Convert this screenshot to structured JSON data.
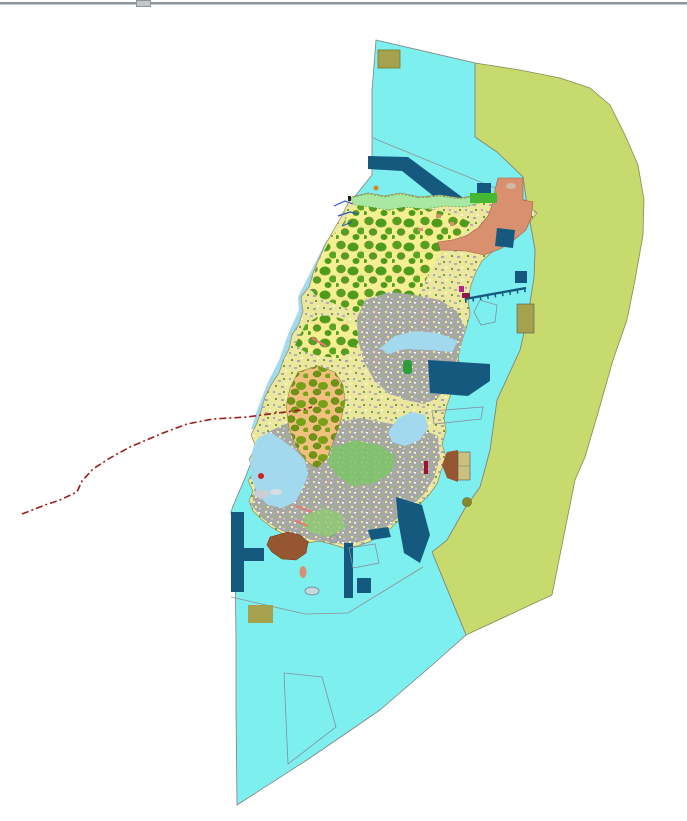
{
  "window": {
    "edge_bar_color": "#8C969C",
    "edge_bar_highlight": "#C4CBCF",
    "scroll_tab_color": "#C2C7CA"
  },
  "map": {
    "colors": {
      "background": "#FFFFFF",
      "sea": "#7EEFEF",
      "outer_zone": "#C6DA6E",
      "zone_border": "#8A8A50",
      "island_outline": "#8A8A5A",
      "forest_green": "#55A01E",
      "orchard_tan": "#EFC07E",
      "orchard_olive": "#6F9414",
      "urban_gray": "#A7A7A7",
      "coast_greenbelt": "#A9E8A2",
      "bright_green_parcel": "#44B830",
      "inlet_blue": "#A3D9EE",
      "salmon_zone": "#D8906F",
      "navy_structure": "#16597F",
      "khaki_parcel": "#A5A14D",
      "khaki_parcel_light": "#CCC07E",
      "brown_area": "#96562F",
      "olive_islet": "#8A8A20",
      "boundary_line": "#909090",
      "dashed_red_line": "#9B1C1C",
      "river_blue": "#2A52BE",
      "shoal_gray": "#C9CFD4",
      "islet_fill": "#C8D8E0",
      "magenta_mark": "#C0208A",
      "crimson_mark": "#A01030",
      "rose_mark": "#E87878",
      "orange_dot": "#E08020"
    },
    "features": [
      {
        "name": "nearshore-sea-zone",
        "color_key": "sea"
      },
      {
        "name": "outer-coastal-zone",
        "color_key": "outer_zone"
      },
      {
        "name": "island-landmass",
        "color_key": "island_outline"
      },
      {
        "name": "northern-forest-area",
        "color_key": "forest_green"
      },
      {
        "name": "central-orchard-area",
        "color_key": "orchard_tan"
      },
      {
        "name": "urban-built-up-areas",
        "color_key": "urban_gray"
      },
      {
        "name": "north-coast-greenbelt",
        "color_key": "coast_greenbelt"
      },
      {
        "name": "northeast-salmon-zone",
        "color_key": "salmon_zone"
      },
      {
        "name": "harbor-structures",
        "color_key": "navy_structure"
      },
      {
        "name": "khaki-parcels",
        "color_key": "khaki_parcel"
      },
      {
        "name": "brown-headland",
        "color_key": "brown_area"
      },
      {
        "name": "coastal-inlets",
        "color_key": "inlet_blue"
      },
      {
        "name": "dashed-red-boundary-line",
        "color_key": "dashed_red_line"
      },
      {
        "name": "sea-parcel-outlines",
        "color_key": "boundary_line"
      },
      {
        "name": "rivers",
        "color_key": "river_blue"
      }
    ]
  }
}
